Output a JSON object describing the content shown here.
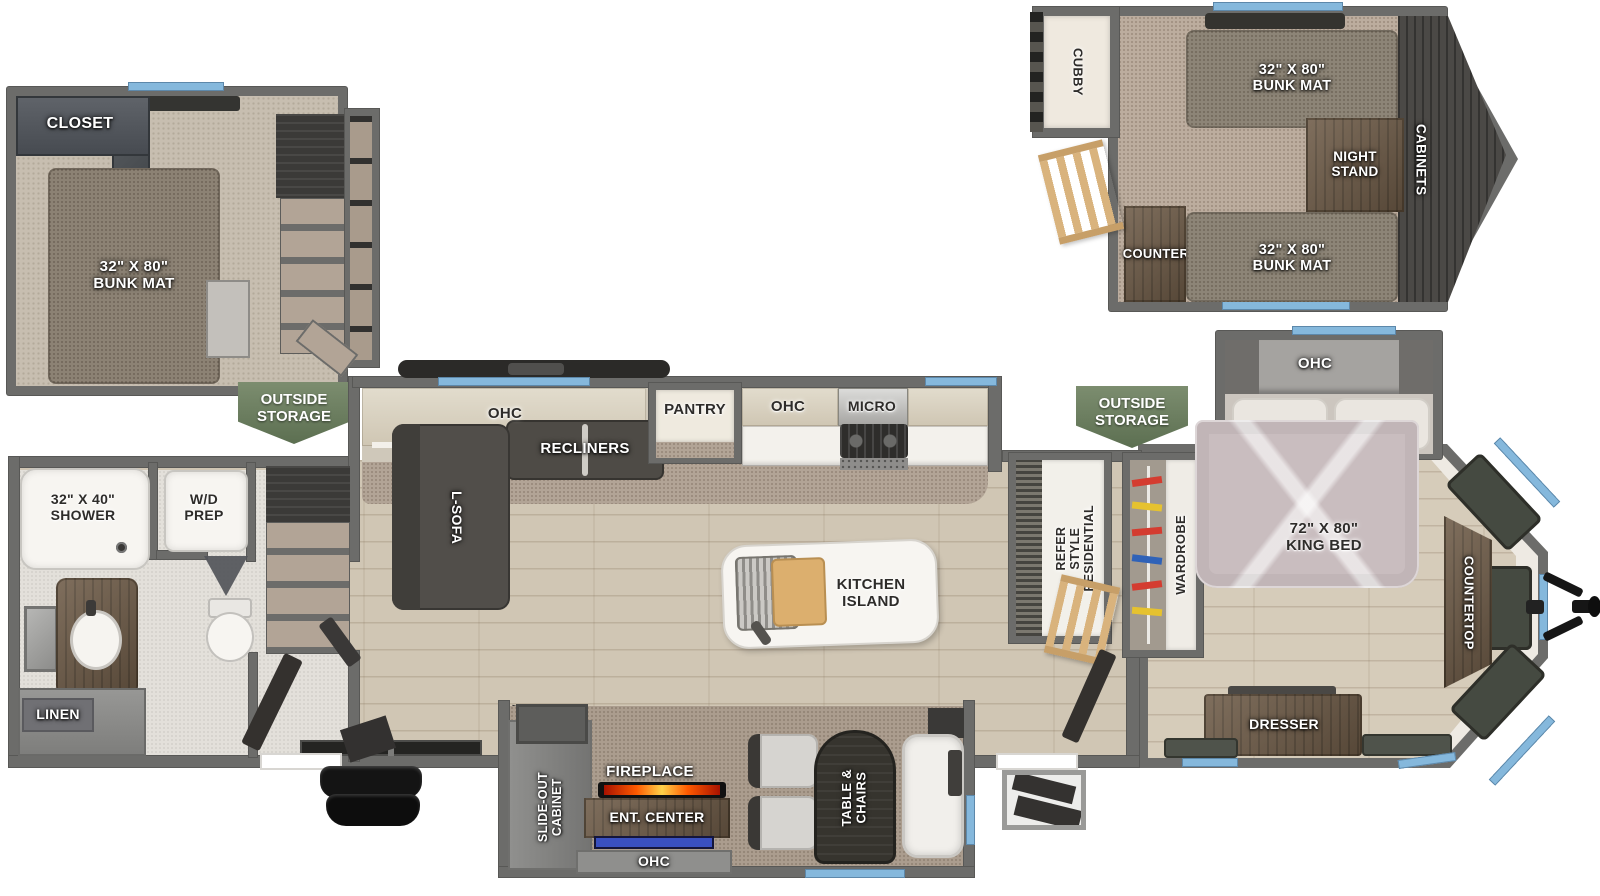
{
  "colors": {
    "wall": "#6c6c6a",
    "window_blue": "#85b8dc",
    "badge_green": "#6b7f5f",
    "wood_floor": "#d0c6b4",
    "carpet": "#b2a496",
    "dark_furniture": "#4e4b46",
    "wood_furniture": "#6e5b47",
    "cabinet_cream": "#d9d2c2",
    "flame_orange": "#ff6a00",
    "tv_blue": "#3a50c0"
  },
  "rear_loft": {
    "closet": "CLOSET",
    "bunk_mat": "32\" X 80\"\nBUNK MAT",
    "outside_storage": "OUTSIDE\nSTORAGE"
  },
  "front_loft": {
    "cubby": "CUBBY",
    "bunk_mat_top": "32\" X 80\"\nBUNK MAT",
    "night_stand": "NIGHT\nSTAND",
    "cabinets": "CABINETS",
    "counter": "COUNTER",
    "bunk_mat_bottom": "32\" X 80\"\nBUNK MAT"
  },
  "bathroom": {
    "shower": "32\" X 40\"\nSHOWER",
    "wd_prep": "W/D\nPREP",
    "linen": "LINEN"
  },
  "living": {
    "ohc": "OHC",
    "recliners": "RECLINERS",
    "l_sofa": "L-SOFA"
  },
  "kitchen": {
    "pantry": "PANTRY",
    "ohc": "OHC",
    "micro": "MICRO",
    "island": "KITCHEN\nISLAND",
    "refer": "RESIDENTIAL\nSTYLE\nREFER"
  },
  "bedroom": {
    "ohc": "OHC",
    "outside_storage": "OUTSIDE\nSTORAGE",
    "wardrobe": "WARDROBE",
    "king_bed": "72\" X 80\"\nKING BED",
    "countertop": "COUNTERTOP",
    "dresser": "DRESSER"
  },
  "entertainment": {
    "slide_out_cabinet": "SLIDE-OUT\nCABINET",
    "fireplace": "FIREPLACE",
    "ent_center": "ENT. CENTER",
    "ohc": "OHC",
    "table_chairs": "TABLE &\nCHAIRS"
  }
}
